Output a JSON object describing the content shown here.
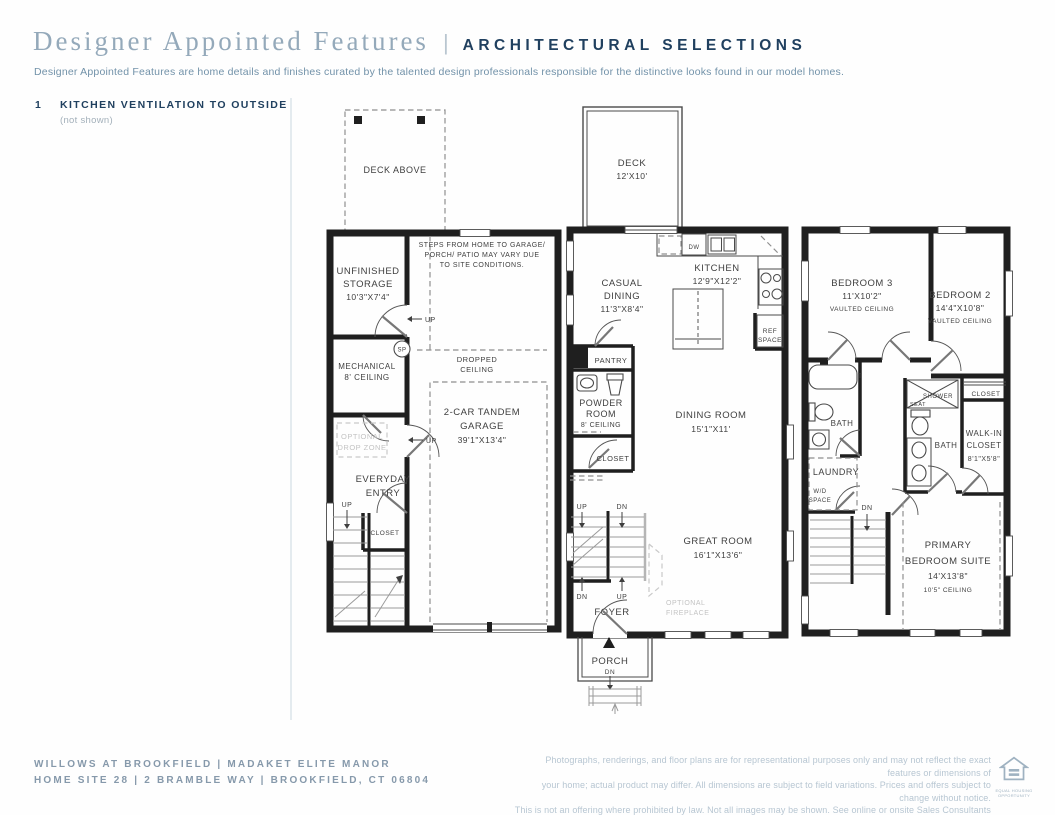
{
  "colors": {
    "accent_navy": "#20405f",
    "muted_title_blue": "#94a9ba",
    "body_blue": "#7292a9",
    "footer_blue": "#8699ab",
    "disclaimer_blue": "#b7c6d2",
    "plan_ink": "#1f1f1f",
    "optional_gray": "#c3c3c3"
  },
  "header": {
    "title": "Designer Appointed Features",
    "separator": "|",
    "section": "ARCHITECTURAL SELECTIONS",
    "description": "Designer Appointed Features are home details and finishes curated by the talented design professionals responsible for the distinctive looks found in our model homes."
  },
  "feature_note": {
    "number": "1",
    "title": "KITCHEN VENTILATION TO OUTSIDE",
    "note": "(not shown)"
  },
  "plan_lower": {
    "deck_above": "DECK ABOVE",
    "unfinished_storage": {
      "l1": "UNFINISHED",
      "l2": "STORAGE",
      "l3": "10'3\"X7'4\""
    },
    "steps_note": {
      "l1": "STEPS FROM HOME TO GARAGE/",
      "l2": "PORCH/ PATIO MAY VARY DUE",
      "l3": "TO SITE CONDITIONS."
    },
    "mechanical": {
      "l1": "MECHANICAL",
      "l2": "8' CEILING"
    },
    "sp": "SP",
    "up_door1": "UP",
    "up_door2": "UP",
    "dropped_ceiling": {
      "l1": "DROPPED",
      "l2": "CEILING"
    },
    "garage": {
      "l1": "2-CAR TANDEM",
      "l2": "GARAGE",
      "l3": "39'1\"X13'4\""
    },
    "optional_drop_zone": {
      "l1": "OPTIONAL",
      "l2": "DROP ZONE"
    },
    "everyday_entry": {
      "l1": "EVERYDAY",
      "l2": "ENTRY"
    },
    "up_stair": "UP",
    "closet": "CLOSET"
  },
  "plan_main": {
    "deck": {
      "l1": "DECK",
      "l2": "12'X10'"
    },
    "casual_dining": {
      "l1": "CASUAL",
      "l2": "DINING",
      "l3": "11'3\"X8'4\""
    },
    "kitchen": {
      "l1": "KITCHEN",
      "l2": "12'9\"X12'2\""
    },
    "dw": "DW",
    "ref_space": {
      "l1": "REF",
      "l2": "SPACE"
    },
    "pantry": "PANTRY",
    "powder_room": {
      "l1": "POWDER",
      "l2": "ROOM",
      "l3": "8' CEILING"
    },
    "closet": "CLOSET",
    "dining_room": {
      "l1": "DINING ROOM",
      "l2": "15'1\"X11'"
    },
    "stair_up_top": "UP",
    "stair_dn_top": "DN",
    "stair_dn_bottom": "DN",
    "stair_up_bottom": "UP",
    "great_room": {
      "l1": "GREAT ROOM",
      "l2": "16'1\"X13'6\""
    },
    "optional_fireplace": {
      "l1": "OPTIONAL",
      "l2": "FIREPLACE"
    },
    "foyer": "FOYER",
    "porch": "PORCH",
    "porch_dn": "DN"
  },
  "plan_upper": {
    "bedroom3": {
      "l1": "BEDROOM 3",
      "l2": "11'X10'2\"",
      "l3": "VAULTED CEILING"
    },
    "bedroom2": {
      "l1": "BEDROOM 2",
      "l2": "14'4\"X10'8\"",
      "l3": "VAULTED CEILING"
    },
    "closet_b3": "CLOSET",
    "closet_b2": "CLOSET",
    "bath1": "BATH",
    "bath2": "BATH",
    "shower": "SHOWER",
    "seat": "SEAT",
    "laundry": "LAUNDRY",
    "wd_space": {
      "l1": "W/D",
      "l2": "SPACE"
    },
    "stair_dn": "DN",
    "walk_in_closet": {
      "l1": "WALK-IN",
      "l2": "CLOSET",
      "l3": "8'1\"X5'8\""
    },
    "primary": {
      "l1": "PRIMARY",
      "l2": "BEDROOM SUITE",
      "l3": "14'X13'8\"",
      "l4": "10'5\" CEILING"
    }
  },
  "footer": {
    "community": "WILLOWS AT BROOKFIELD  |  MADAKET ELITE MANOR",
    "address": "HOME SITE 28  |  2 BRAMBLE WAY  |  BROOKFIELD, CT 06804",
    "disclaimer_lines": [
      "Photographs, renderings, and floor plans are for representational purposes only and may not reflect the exact features or dimensions of",
      "your home; actual product may differ. All dimensions are subject to field variations. Prices and offers subject to change without notice.",
      "This is not an offering where prohibited by law. Not all images may be shown. See online or onsite Sales Consultants for details."
    ],
    "equal_housing": "EQUAL HOUSING OPPORTUNITY"
  }
}
